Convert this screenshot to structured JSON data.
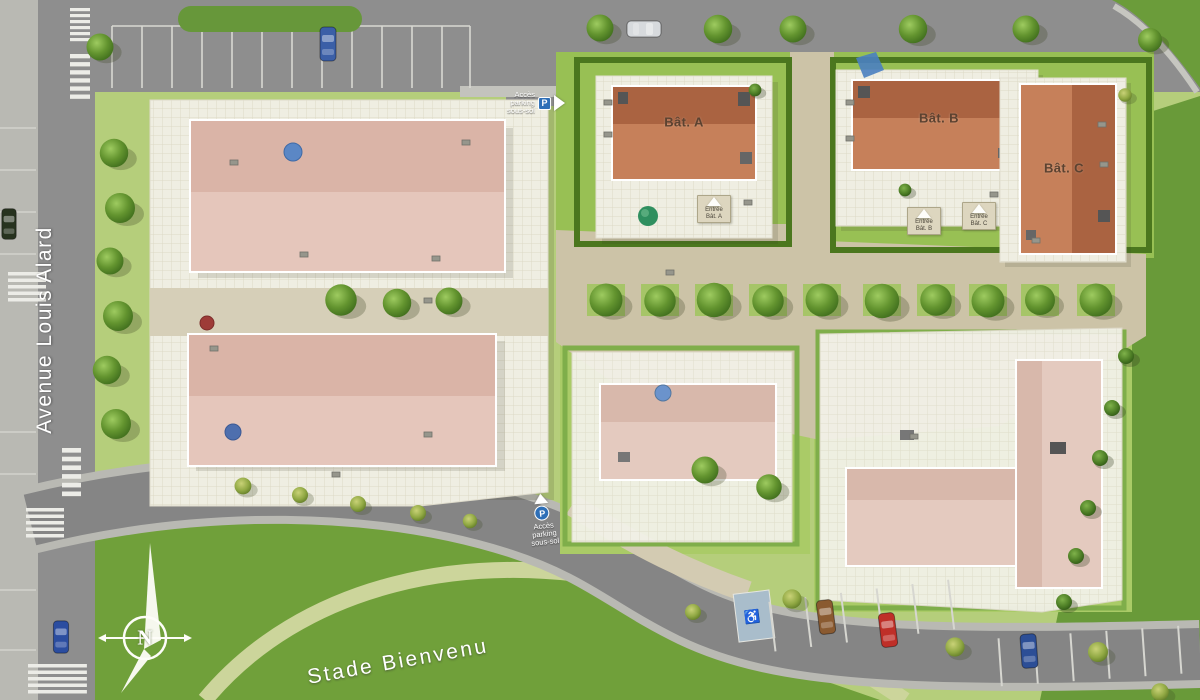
{
  "plan": {
    "streets": {
      "avenue": "Avenue Louis Alard",
      "stadium": "Stade Bienvenu"
    },
    "buildings": {
      "a": "Bât. A",
      "b": "Bât. B",
      "c": "Bât. C"
    },
    "entrances": {
      "a": {
        "line1": "Entrée",
        "line2": "Bât. A"
      },
      "b": {
        "line1": "Entrée",
        "line2": "Bât. B"
      },
      "c": {
        "line1": "Entrée",
        "line2": "Bât. C"
      }
    },
    "parking_access_top": {
      "line1": "Accès",
      "line2": "parking",
      "line3": "sous-sol",
      "icon": "P"
    },
    "parking_access_bottom": {
      "line1": "Accès",
      "line2": "parking",
      "line3": "sous-sol",
      "icon": "P"
    },
    "compass": {
      "north": "N"
    },
    "icons": {
      "wheelchair": "♿"
    },
    "colors": {
      "road": "#8e8e8e",
      "sidewalk": "#b9b9b3",
      "field_green": "#70a03a",
      "site_lawn": "#b5ce7b",
      "hedge": "#4b771e",
      "roof_terracotta": "#c6805a",
      "roof_terracotta_dark": "#aa6341",
      "roof_pink": "#e5c6bb",
      "plaza_beige": "#ccc3a7",
      "parking_blue": "#2e6fb7"
    }
  }
}
